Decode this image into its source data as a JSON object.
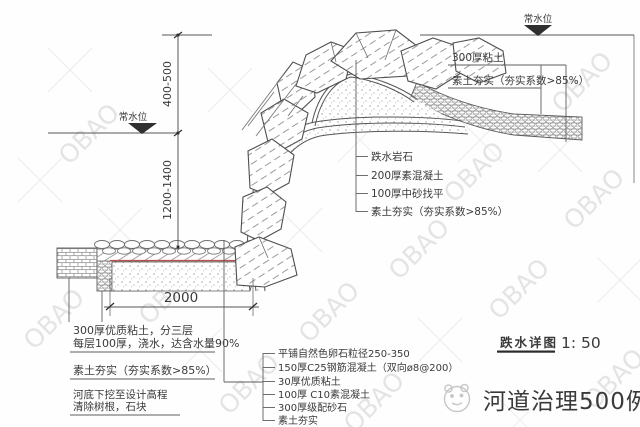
{
  "title": {
    "label": "跌水详图",
    "scale": "1: 50"
  },
  "water_level": {
    "left": "常水位",
    "right": "常水位"
  },
  "dims": {
    "upper": "400-500",
    "lower": "1200-1400",
    "width": "2000"
  },
  "right_callouts": {
    "clay": "300厚粘土",
    "soil": "素土夯实（夯实系数>85%）"
  },
  "mid_callouts": {
    "items": [
      "跌水岩石",
      "200厚素混凝土",
      "100厚中砂找平",
      "素土夯实（夯实系数>85%）"
    ]
  },
  "left_notes": {
    "note1_line1": "300厚优质粘土，分三层",
    "note1_line2": "每层100厚，浇水，达含水量90%",
    "note2": "素土夯实（夯实系数>85%）",
    "note3_line1": "河底下挖至设计高程",
    "note3_line2": "清除树根，石块"
  },
  "bottom_callouts": {
    "items": [
      "平铺自然色卵石粒径250-350",
      "150厚C25钢筋混凝土（双向ø8@200）",
      "30厚优质粘土",
      "100厚 C10素混凝土",
      "300厚级配砂石",
      "素土夯实"
    ]
  },
  "watermark": {
    "obao": "OBAO",
    "brand": "河道治理500例"
  },
  "colors": {
    "line": "#565656",
    "red": "#c0504d"
  }
}
